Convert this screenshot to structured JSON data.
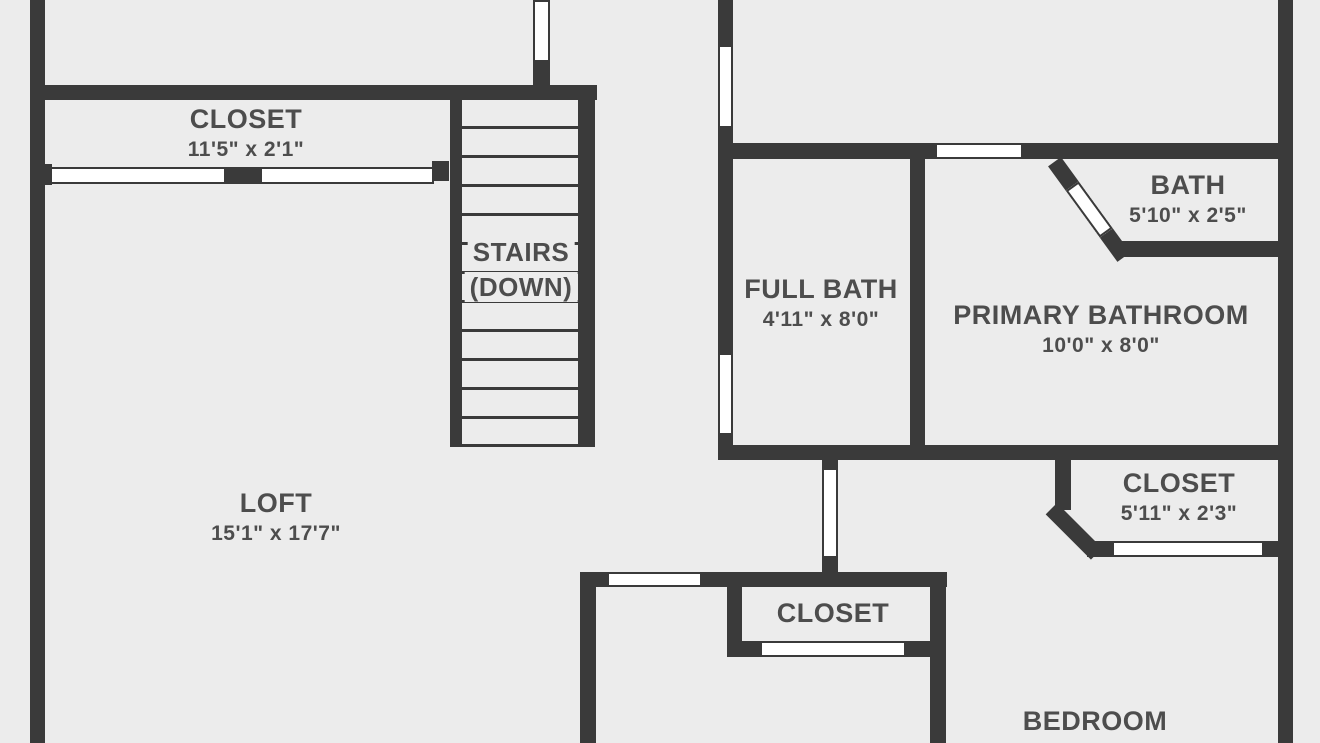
{
  "floor_plan": {
    "colors": {
      "wall": "#3a3a3a",
      "floor": "#ececec",
      "opening": "#ffffff",
      "label_text": "#4d4d4d"
    },
    "rooms": [
      {
        "id": "closet-upper-left",
        "name": "CLOSET",
        "dims": "11'5\" x 2'1\""
      },
      {
        "id": "stairs",
        "name": "STAIRS",
        "dims": "(DOWN)"
      },
      {
        "id": "full-bath",
        "name": "FULL BATH",
        "dims": "4'11\" x 8'0\""
      },
      {
        "id": "bath",
        "name": "BATH",
        "dims": "5'10\" x 2'5\""
      },
      {
        "id": "primary-bathroom",
        "name": "PRIMARY BATHROOM",
        "dims": "10'0\" x 8'0\""
      },
      {
        "id": "closet-right",
        "name": "CLOSET",
        "dims": "5'11\" x 2'3\""
      },
      {
        "id": "loft",
        "name": "LOFT",
        "dims": "15'1\" x 17'7\""
      },
      {
        "id": "closet-bedroom",
        "name": "CLOSET",
        "dims": ""
      },
      {
        "id": "bedroom",
        "name": "BEDROOM",
        "dims": ""
      }
    ]
  }
}
